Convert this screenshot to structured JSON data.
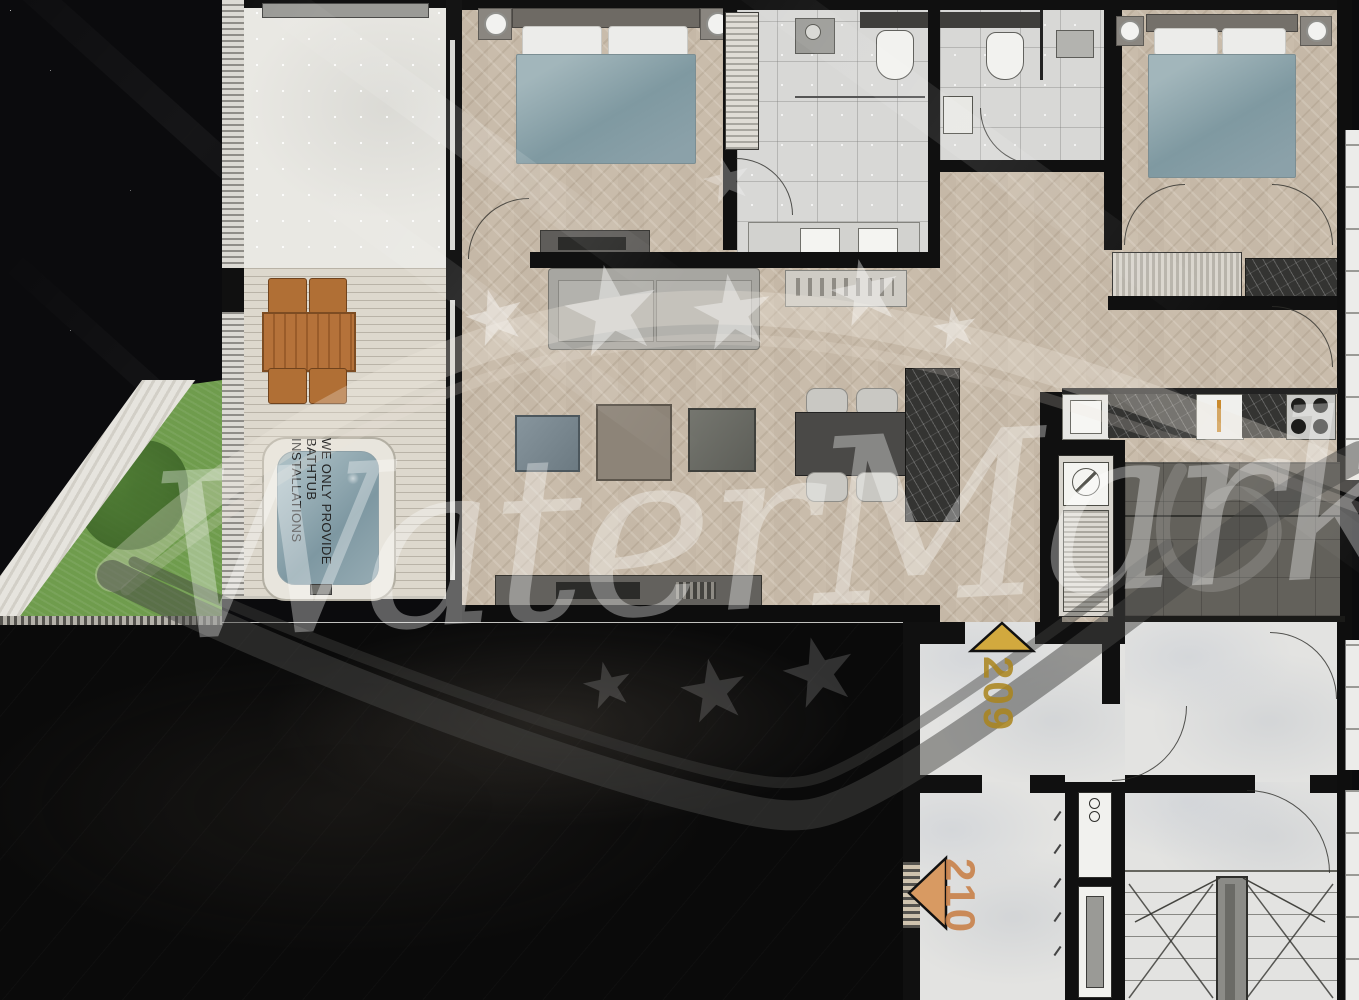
{
  "watermark": {
    "brand_text": "WaterMark",
    "star_icon": "★",
    "note": {
      "line1": "WE ONLY PROVIDE",
      "line2": "BATHTUB",
      "line3": "INSTALLATIONS"
    }
  },
  "markers": {
    "m209": {
      "label": "209",
      "text_color": "#ab851c",
      "triangle_color": "#d2a93e",
      "direction": "up"
    },
    "m210": {
      "label": "210",
      "text_color": "#c9824a",
      "triangle_color": "#d89a62",
      "direction": "left"
    }
  },
  "palette": {
    "night_background": "#0a0a0a",
    "wood_floor": "#c9bcab",
    "tile_floor": "#d8d8d6",
    "deck_floor": "#ddd8cd",
    "wall": "#101010",
    "grass": "#6f9c4d",
    "bed_cover": "#8fa7ae",
    "outdoor_wood_furniture": "#b5723a",
    "watermark_white": "rgba(255,255,255,0.34)"
  }
}
